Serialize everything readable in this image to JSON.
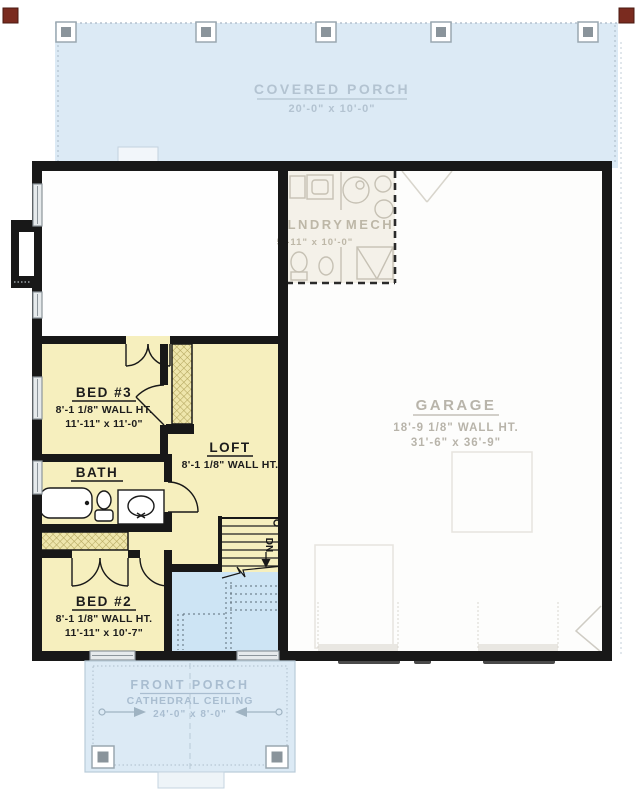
{
  "plan": {
    "covered_porch": {
      "title": "COVERED PORCH",
      "dims": "20'-0\" x 10'-0\""
    },
    "front_porch": {
      "title": "FRONT PORCH",
      "subtitle": "CATHEDRAL CEILING",
      "dims": "24'-0\" x 8'-0\""
    },
    "garage": {
      "title": "GARAGE",
      "wall_ht": "18'-9 1/8\" WALL HT.",
      "dims": "31'-6\" x 36'-9\""
    },
    "bed3": {
      "title": "BED #3",
      "wall_ht": "8'-1 1/8\" WALL HT.",
      "dims": "11'-11\" x 11'-0\""
    },
    "loft": {
      "title": "LOFT",
      "wall_ht": "8'-1 1/8\" WALL HT."
    },
    "bath": {
      "title": "BATH"
    },
    "bed2": {
      "title": "BED #2",
      "wall_ht": "8'-1 1/8\" WALL HT.",
      "dims": "11'-11\" x 10'-7\""
    },
    "lndry": {
      "title": "LNDRY",
      "dims": "5'-11\" x 10'-0\""
    },
    "mech": {
      "title": "MECH"
    },
    "stairs": {
      "label": "DN"
    }
  },
  "colors": {
    "porch_blue": "#dceaf5",
    "open_below_blue": "#cde4f4",
    "loft_yellow": "#f6efbe",
    "ghost_fill": "#f4f1e9",
    "wall_black": "#181818",
    "porch_text": "#b3c3d1",
    "garage_text": "#b8b4aa",
    "accent_red": "#7a2b1f"
  }
}
